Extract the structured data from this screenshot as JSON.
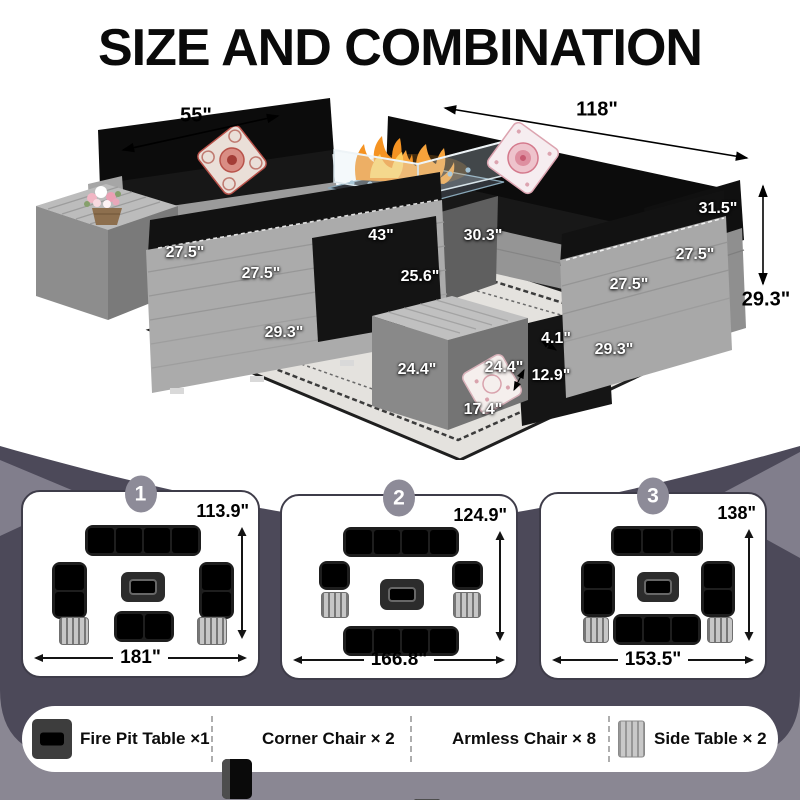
{
  "title": "SIZE AND COMBINATION",
  "photo": {
    "dimension_labels": [
      {
        "text": "55\"",
        "x": 196,
        "y": 116,
        "variant": "outside"
      },
      {
        "text": "118\"",
        "x": 597,
        "y": 110,
        "variant": "outside"
      },
      {
        "text": "29.3\"",
        "x": 766,
        "y": 300,
        "variant": "outside"
      },
      {
        "text": "31.5\"",
        "x": 718,
        "y": 209,
        "variant": "overlay"
      },
      {
        "text": "43\"",
        "x": 381,
        "y": 236,
        "variant": "overlay"
      },
      {
        "text": "30.3\"",
        "x": 483,
        "y": 236,
        "variant": "overlay"
      },
      {
        "text": "25.6\"",
        "x": 420,
        "y": 277,
        "variant": "overlay"
      },
      {
        "text": "27.5\"",
        "x": 185,
        "y": 253,
        "variant": "overlay"
      },
      {
        "text": "27.5\"",
        "x": 261,
        "y": 274,
        "variant": "overlay"
      },
      {
        "text": "29.3\"",
        "x": 284,
        "y": 333,
        "variant": "overlay"
      },
      {
        "text": "27.5\"",
        "x": 695,
        "y": 255,
        "variant": "overlay"
      },
      {
        "text": "27.5\"",
        "x": 629,
        "y": 285,
        "variant": "overlay"
      },
      {
        "text": "29.3\"",
        "x": 614,
        "y": 350,
        "variant": "overlay"
      },
      {
        "text": "4.1\"",
        "x": 556,
        "y": 339,
        "variant": "overlay"
      },
      {
        "text": "12.9\"",
        "x": 551,
        "y": 376,
        "variant": "overlay"
      },
      {
        "text": "24.4\"",
        "x": 417,
        "y": 370,
        "variant": "overlay"
      },
      {
        "text": "24.4\"",
        "x": 504,
        "y": 368,
        "variant": "overlay"
      },
      {
        "text": "17.4\"",
        "x": 483,
        "y": 410,
        "variant": "overlay"
      }
    ]
  },
  "combinations": [
    {
      "badge": "1",
      "depth": "113.9\"",
      "width": "181\"",
      "items": [
        {
          "type": "sofa",
          "seats": 4,
          "dir": "h",
          "x": 62,
          "y": 33,
          "w": 116,
          "h": 31
        },
        {
          "type": "sofa",
          "seats": 2,
          "dir": "v",
          "x": 29,
          "y": 70,
          "w": 35,
          "h": 57
        },
        {
          "type": "sofa",
          "seats": 2,
          "dir": "v",
          "x": 176,
          "y": 70,
          "w": 35,
          "h": 57
        },
        {
          "type": "firepit",
          "x": 98,
          "y": 80,
          "w": 44,
          "h": 30
        },
        {
          "type": "sofa",
          "seats": 2,
          "dir": "h",
          "x": 91,
          "y": 119,
          "w": 60,
          "h": 31
        },
        {
          "type": "sidetable",
          "x": 36,
          "y": 125,
          "w": 30,
          "h": 28
        },
        {
          "type": "sidetable",
          "x": 174,
          "y": 125,
          "w": 30,
          "h": 28
        }
      ]
    },
    {
      "badge": "2",
      "depth": "124.9\"",
      "width": "166.8\"",
      "items": [
        {
          "type": "sofa",
          "seats": 4,
          "dir": "h",
          "x": 61,
          "y": 31,
          "w": 116,
          "h": 30
        },
        {
          "type": "sofa",
          "seats": 1,
          "dir": "v",
          "x": 37,
          "y": 65,
          "w": 31,
          "h": 29
        },
        {
          "type": "sofa",
          "seats": 1,
          "dir": "v",
          "x": 170,
          "y": 65,
          "w": 31,
          "h": 29
        },
        {
          "type": "sidetable",
          "x": 39,
          "y": 96,
          "w": 28,
          "h": 26
        },
        {
          "type": "sidetable",
          "x": 171,
          "y": 96,
          "w": 28,
          "h": 26
        },
        {
          "type": "firepit",
          "x": 98,
          "y": 83,
          "w": 44,
          "h": 31
        },
        {
          "type": "sofa",
          "seats": 4,
          "dir": "h",
          "x": 61,
          "y": 130,
          "w": 116,
          "h": 30
        }
      ]
    },
    {
      "badge": "3",
      "depth": "138\"",
      "width": "153.5\"",
      "items": [
        {
          "type": "sofa",
          "seats": 3,
          "dir": "h",
          "x": 70,
          "y": 32,
          "w": 92,
          "h": 30
        },
        {
          "type": "sofa",
          "seats": 2,
          "dir": "v",
          "x": 40,
          "y": 67,
          "w": 34,
          "h": 56
        },
        {
          "type": "sofa",
          "seats": 2,
          "dir": "v",
          "x": 160,
          "y": 67,
          "w": 34,
          "h": 56
        },
        {
          "type": "firepit",
          "x": 96,
          "y": 78,
          "w": 42,
          "h": 30
        },
        {
          "type": "sofa",
          "seats": 3,
          "dir": "h",
          "x": 72,
          "y": 120,
          "w": 88,
          "h": 31
        },
        {
          "type": "sidetable",
          "x": 42,
          "y": 123,
          "w": 26,
          "h": 26
        },
        {
          "type": "sidetable",
          "x": 166,
          "y": 123,
          "w": 26,
          "h": 26
        }
      ]
    }
  ],
  "legend": [
    {
      "icon": "fire-pit-table-icon",
      "label": "Fire Pit Table ×1"
    },
    {
      "icon": "corner-chair-icon",
      "label": "Corner Chair × 2"
    },
    {
      "icon": "armless-chair-icon",
      "label": "Armless Chair × 8"
    },
    {
      "icon": "side-table-icon",
      "label": "Side Table × 2"
    }
  ],
  "colors": {
    "background_dark": "#4c4959",
    "background_light": "#8a8793",
    "accent_wedge": "#817e8c",
    "card_border": "#3e3c49",
    "badge_gray": "#8d8b98",
    "cushion_black": "#0d0d0d",
    "rattan_gray": "#a6a6a6",
    "flame_orange": "#f59322",
    "flame_yellow": "#ffce5e",
    "pillow_red": "#c2554e",
    "pillow_pink": "#e38a96"
  }
}
